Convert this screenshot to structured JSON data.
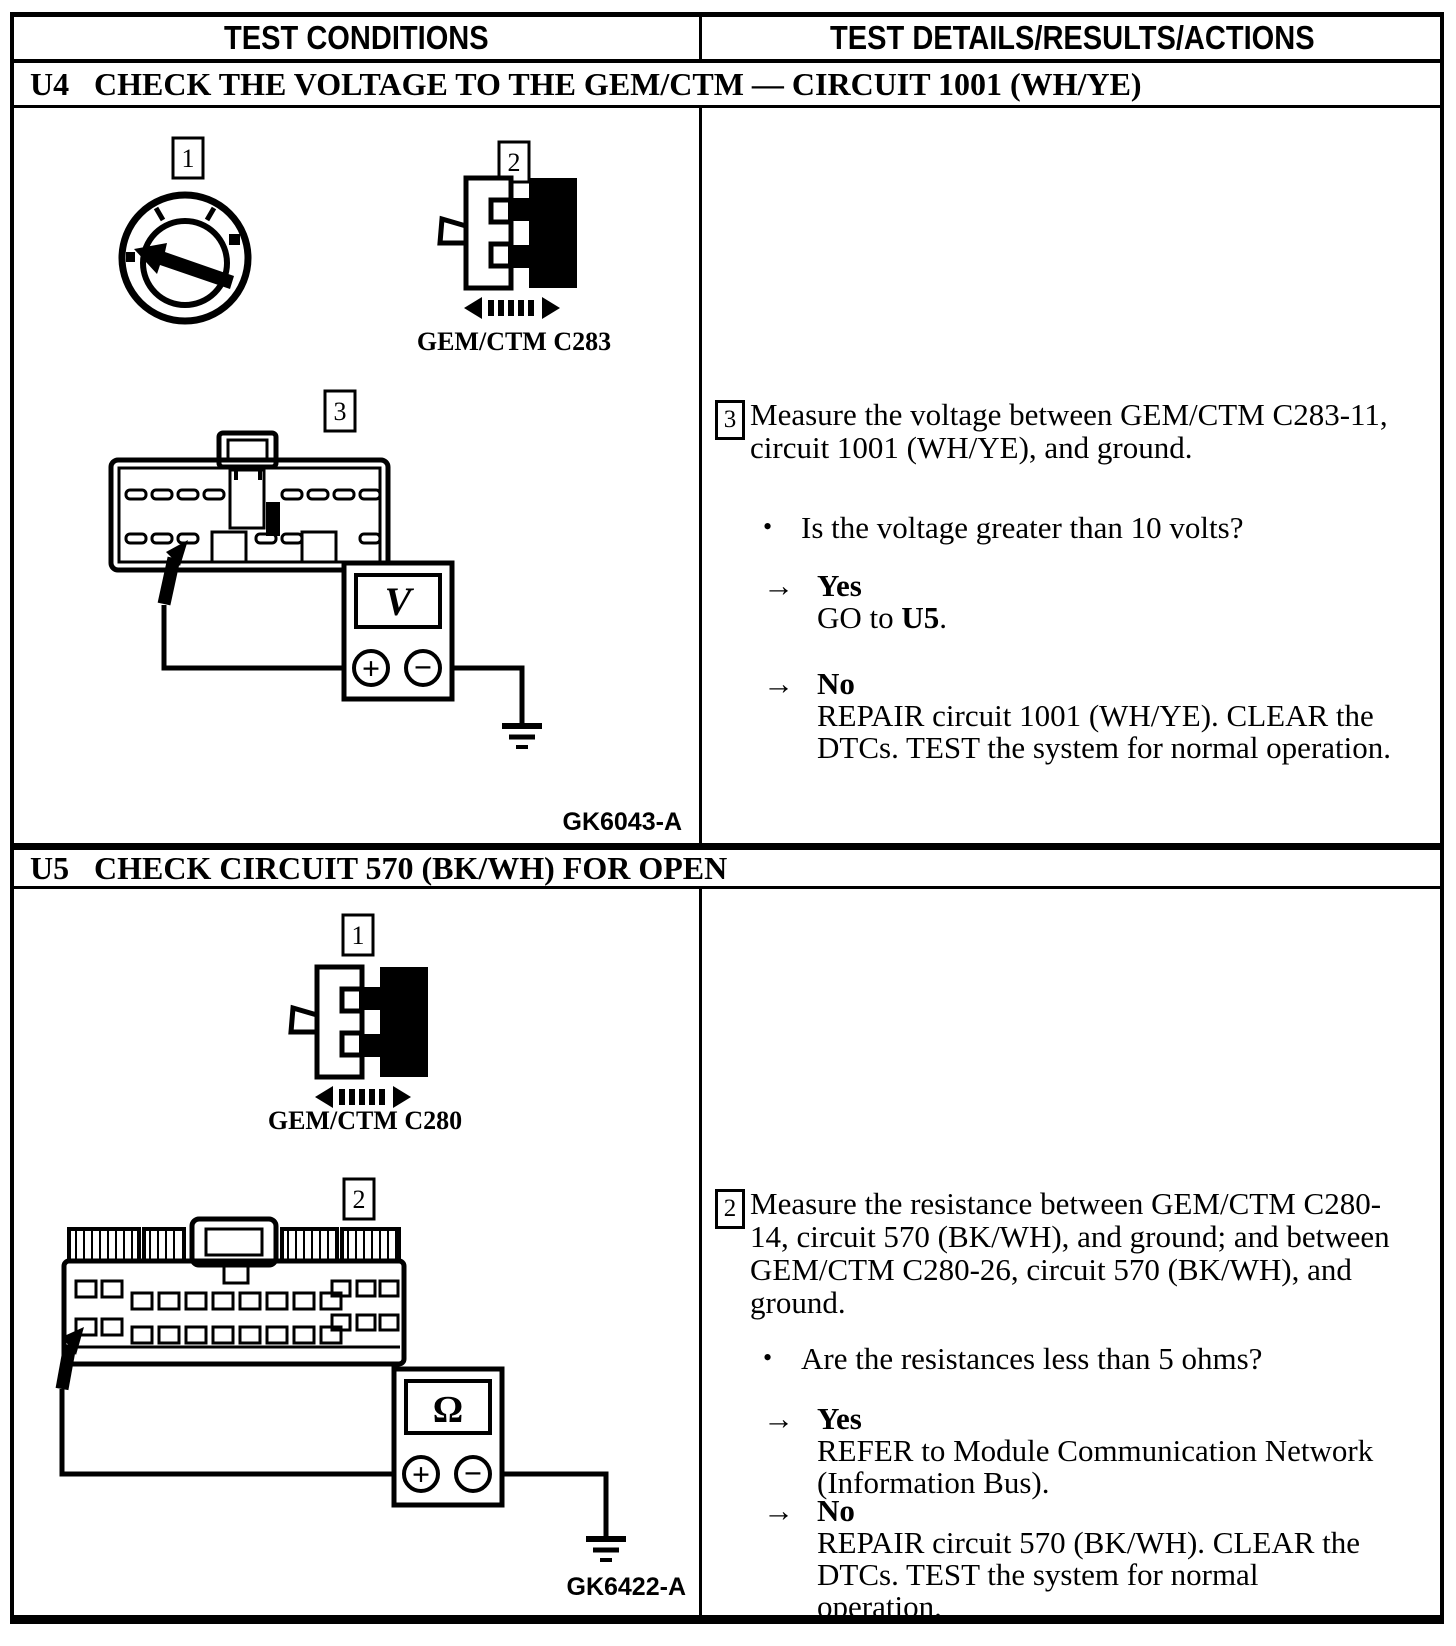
{
  "header": {
    "col_conditions": "TEST CONDITIONS",
    "col_details": "TEST DETAILS/RESULTS/ACTIONS"
  },
  "symbols": {
    "bullet": "•",
    "arrow": "→",
    "plus": "+",
    "minus": "−"
  },
  "u4": {
    "id": "U4",
    "title": "CHECK THE VOLTAGE TO THE GEM/CTM — CIRCUIT 1001 (WH/YE)",
    "marker_1": "1",
    "marker_2": "2",
    "marker_3": "3",
    "connector_label": "GEM/CTM C283",
    "meter_symbol": "V",
    "figure_code": "GK6043-A",
    "details": {
      "step_no": "3",
      "instruction": "Measure the voltage between GEM/CTM C283-11, circuit 1001 (WH/YE), and ground.",
      "question": "Is the voltage greater than 10 volts?",
      "yes_label": "Yes",
      "yes_action_pre": "GO to ",
      "yes_action_bold": "U5",
      "yes_action_post": ".",
      "no_label": "No",
      "no_action": "REPAIR circuit 1001 (WH/YE). CLEAR the DTCs. TEST the system for normal operation."
    }
  },
  "u5": {
    "id": "U5",
    "title": "CHECK CIRCUIT 570 (BK/WH) FOR OPEN",
    "marker_1": "1",
    "marker_2": "2",
    "connector_label": "GEM/CTM C280",
    "meter_symbol": "Ω",
    "figure_code": "GK6422-A",
    "details": {
      "step_no": "2",
      "instruction": "Measure the resistance between GEM/CTM C280-14, circuit 570 (BK/WH), and ground; and between GEM/CTM C280-26, circuit 570 (BK/WH), and ground.",
      "question": "Are the resistances less than 5 ohms?",
      "yes_label": "Yes",
      "yes_action": "REFER to Module Communication Network (Information Bus).",
      "no_label": "No",
      "no_action": "REPAIR circuit 570 (BK/WH). CLEAR the DTCs. TEST the system for normal operation."
    }
  }
}
